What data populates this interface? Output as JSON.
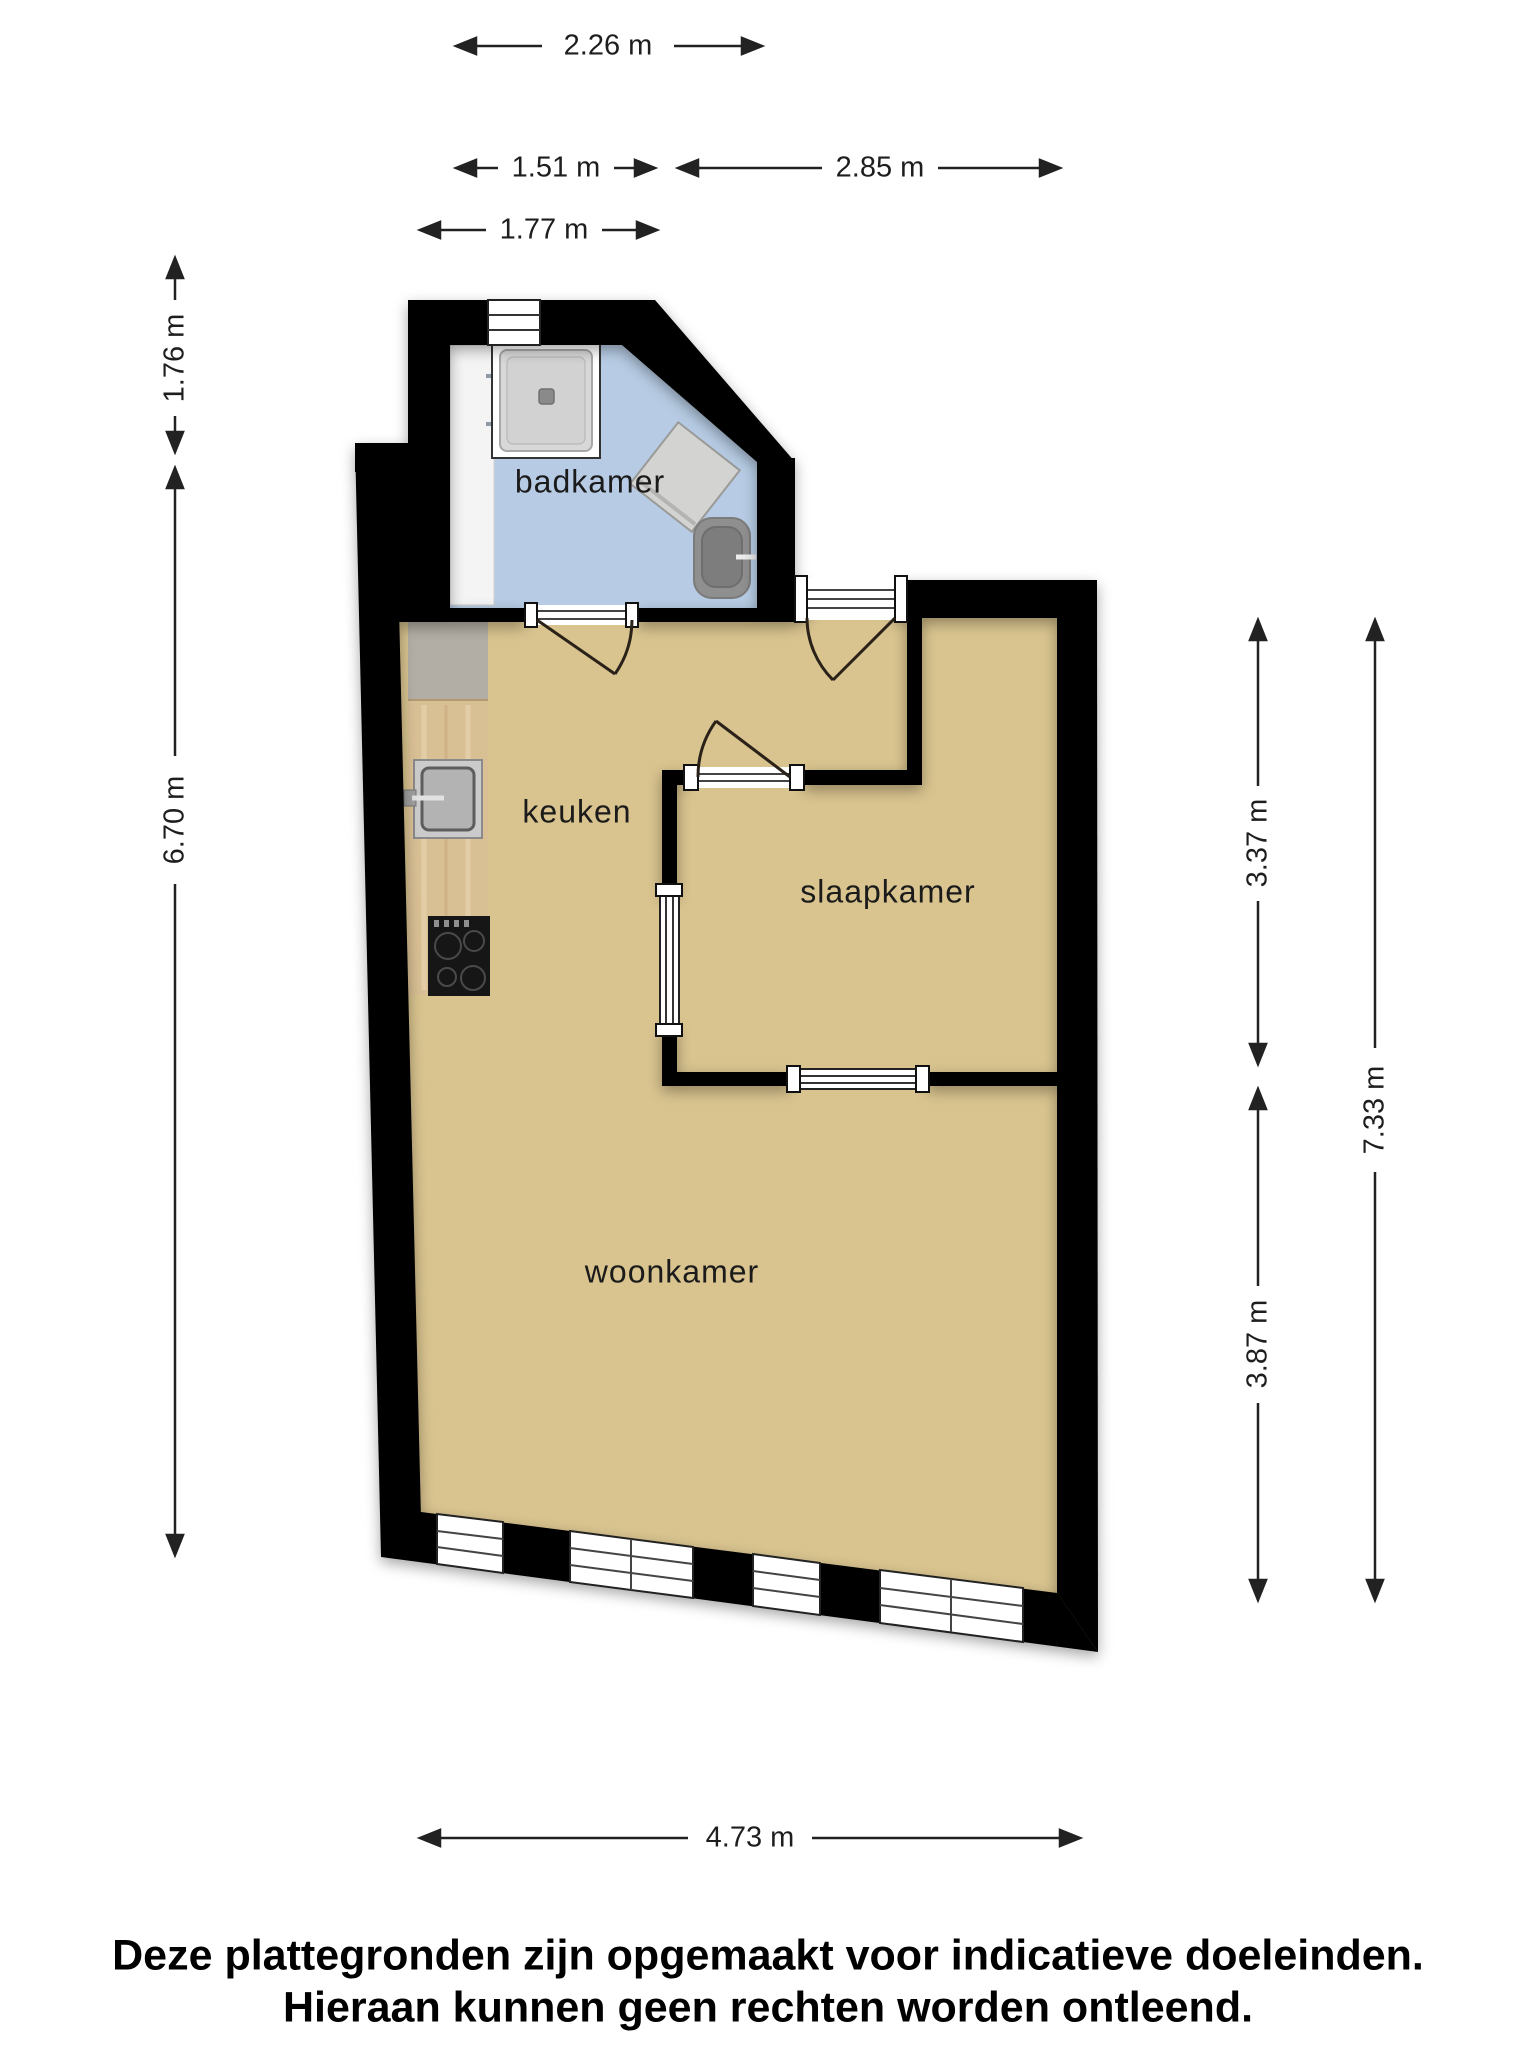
{
  "rooms": {
    "bathroom": "badkamer",
    "kitchen": "keuken",
    "bedroom": "slaapkamer",
    "living": "woonkamer"
  },
  "dims": {
    "top_226": "2.26 m",
    "top_151": "1.51 m",
    "top_285": "2.85 m",
    "top_177": "1.77 m",
    "left_176": "1.76 m",
    "left_670": "6.70 m",
    "right_337": "3.37 m",
    "right_387": "3.87 m",
    "right_733": "7.33 m",
    "bottom_473": "4.73 m"
  },
  "fixtures": {
    "shower": "shower",
    "washing_machine": "washing-machine",
    "toilet": "toilet",
    "bathroom_counter": "bathroom-sink-counter",
    "kitchen_sink": "kitchen-sink",
    "cooktop": "cooktop"
  },
  "colors": {
    "wall": "#000000",
    "bathroom_floor": "#b7cce4",
    "living_floor": "#d9c48f",
    "counter_gray": "#b3aea5",
    "counter_wood": "#d9bf94",
    "dim_line": "#222222"
  },
  "disclaimer": {
    "line1": "Deze plattegronden zijn opgemaakt voor indicatieve doeleinden.",
    "line2": "Hieraan kunnen geen rechten worden ontleend."
  }
}
